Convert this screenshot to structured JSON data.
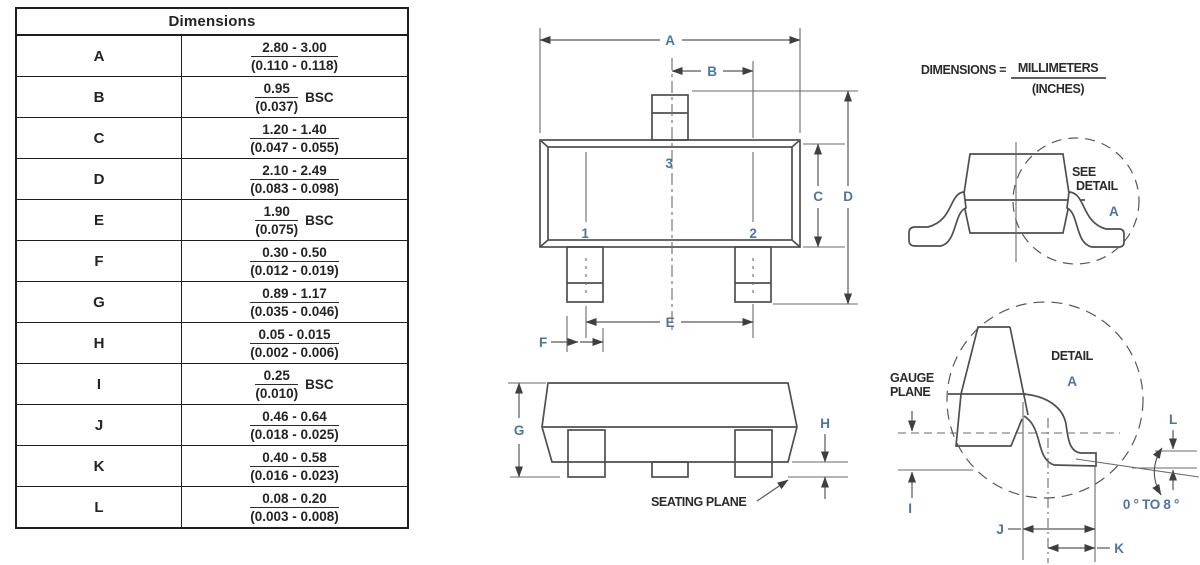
{
  "table": {
    "title": "Dimensions",
    "rows": [
      {
        "letter": "A",
        "mm": "2.80 - 3.00",
        "inches": "(0.110 - 0.118)",
        "bsc": ""
      },
      {
        "letter": "B",
        "mm": "0.95",
        "inches": "(0.037)",
        "bsc": "BSC"
      },
      {
        "letter": "C",
        "mm": "1.20 - 1.40",
        "inches": "(0.047 - 0.055)",
        "bsc": ""
      },
      {
        "letter": "D",
        "mm": "2.10 - 2.49",
        "inches": "(0.083 - 0.098)",
        "bsc": ""
      },
      {
        "letter": "E",
        "mm": "1.90",
        "inches": "(0.075)",
        "bsc": "BSC"
      },
      {
        "letter": "F",
        "mm": "0.30 - 0.50",
        "inches": "(0.012 - 0.019)",
        "bsc": ""
      },
      {
        "letter": "G",
        "mm": "0.89 - 1.17",
        "inches": "(0.035 - 0.046)",
        "bsc": ""
      },
      {
        "letter": "H",
        "mm": "0.05 - 0.015",
        "inches": "(0.002 - 0.006)",
        "bsc": ""
      },
      {
        "letter": "I",
        "mm": "0.25",
        "inches": "(0.010)",
        "bsc": "BSC"
      },
      {
        "letter": "J",
        "mm": "0.46 - 0.64",
        "inches": "(0.018 - 0.025)",
        "bsc": ""
      },
      {
        "letter": "K",
        "mm": "0.40 - 0.58",
        "inches": "(0.016 - 0.023)",
        "bsc": ""
      },
      {
        "letter": "L",
        "mm": "0.08 - 0.20",
        "inches": "(0.003 - 0.008)",
        "bsc": ""
      }
    ]
  },
  "note": {
    "prefix": "DIMENSIONS =",
    "numerator": "MILLIMETERS",
    "denominator": "(INCHES)"
  },
  "top_view": {
    "dim_a": "A",
    "dim_b": "B",
    "dim_c": "C",
    "dim_d": "D",
    "dim_e": "E",
    "dim_f": "F",
    "pin1": "1",
    "pin2": "2",
    "pin3": "3"
  },
  "side_view": {
    "dim_g": "G",
    "dim_h": "H",
    "seating_plane": "SEATING PLANE"
  },
  "end_view": {
    "see": "SEE",
    "detail": "DETAIL",
    "a": "A"
  },
  "detail_view": {
    "title_detail": "DETAIL",
    "title_a": "A",
    "gauge_line1": "GAUGE",
    "gauge_line2": "PLANE",
    "dim_i": "I",
    "dim_j": "J",
    "dim_k": "K",
    "dim_l": "L",
    "angle": "0 ° TO 8 °"
  },
  "colors": {
    "dimension_label_blue": "#4a76a4",
    "drawing_line_gray": "#4f4f4f",
    "table_text": "#242424"
  }
}
